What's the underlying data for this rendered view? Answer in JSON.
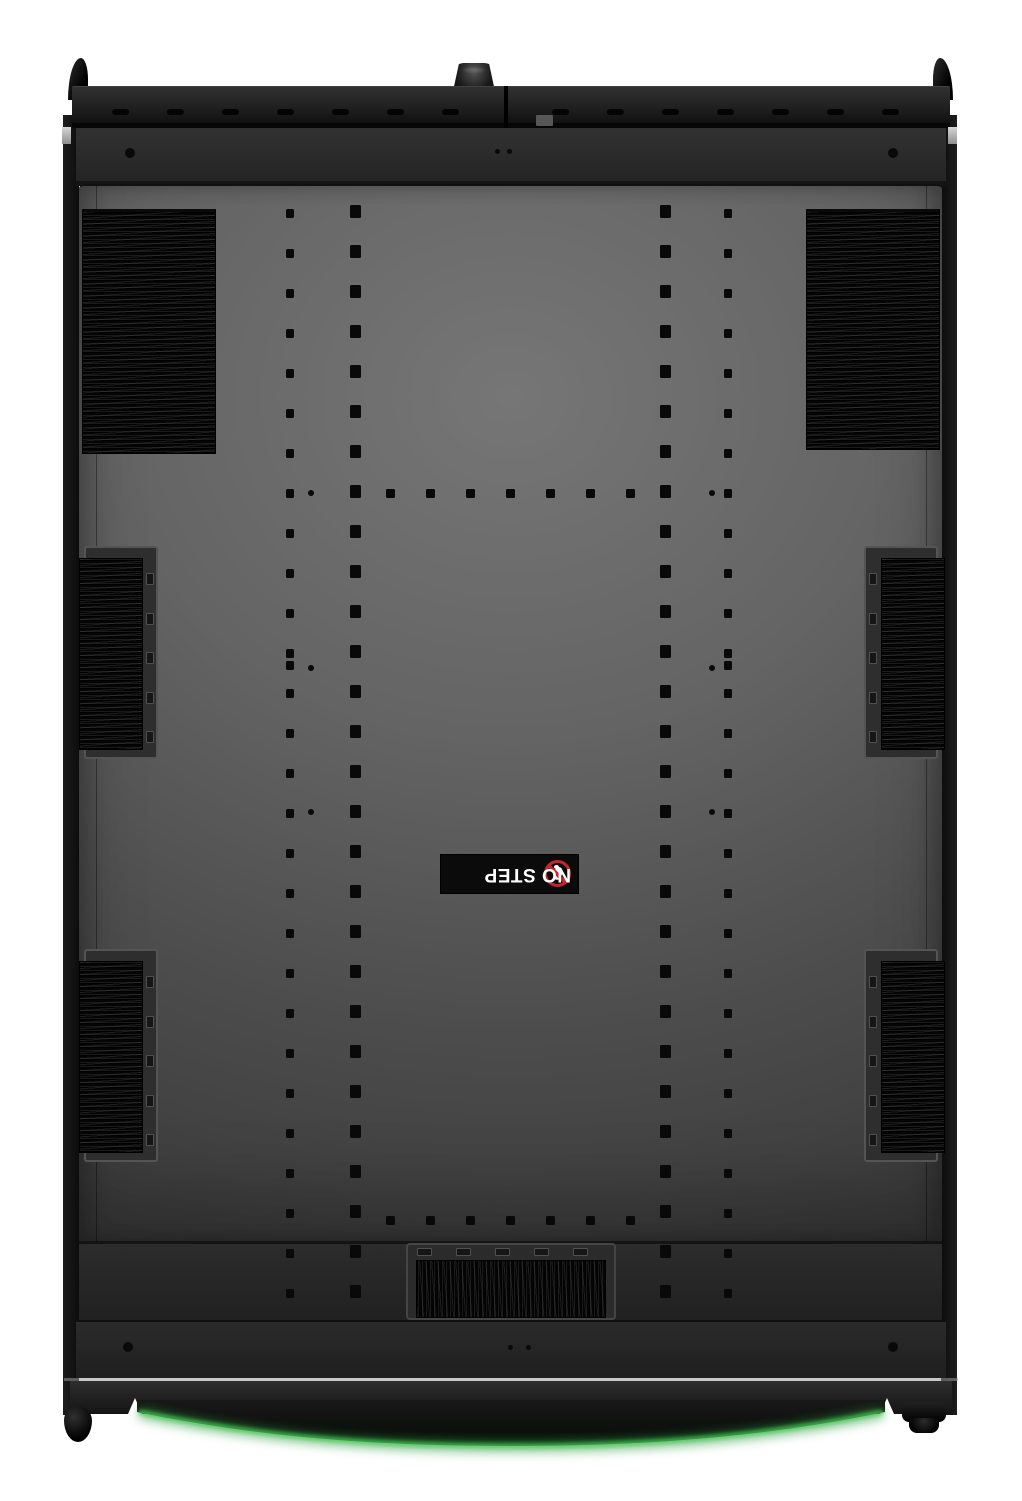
{
  "no_step_label": {
    "text": "NO STEP",
    "icon": "no-step-prohibition-icon"
  },
  "colors": {
    "hole_color": "#090909",
    "label_bg": "#0b0b0b",
    "label_text": "#ffffff",
    "prohibition_red": "#c1272d",
    "glow_green": "#46c455",
    "glow_green_soft": "#2f9e43"
  },
  "perforations": {
    "columns": [
      {
        "x": 290,
        "w": 8,
        "h": 9,
        "y_start": 213,
        "y_end": 1293,
        "step": 40
      },
      {
        "x": 355,
        "w": 11,
        "h": 13,
        "y_start": 211,
        "y_end": 1291,
        "step": 40
      },
      {
        "x": 665,
        "w": 11,
        "h": 13,
        "y_start": 211,
        "y_end": 1291,
        "step": 40
      },
      {
        "x": 728,
        "w": 8,
        "h": 9,
        "y_start": 213,
        "y_end": 1293,
        "step": 40
      }
    ],
    "rows": [
      {
        "y": 493,
        "w": 9,
        "h": 9,
        "x_start": 390,
        "x_end": 630,
        "step": 40
      },
      {
        "y": 1220,
        "w": 9,
        "h": 9,
        "x_start": 390,
        "x_end": 630,
        "step": 40
      }
    ],
    "extra_squares": [
      [
        290,
        665
      ],
      [
        728,
        665
      ]
    ],
    "dots": [
      [
        311,
        493
      ],
      [
        712,
        493
      ],
      [
        311,
        668
      ],
      [
        712,
        668
      ],
      [
        311,
        812
      ],
      [
        712,
        812
      ]
    ]
  },
  "round_holes": {
    "r": 5,
    "positions": [
      [
        130,
        153
      ],
      [
        893,
        153
      ],
      [
        128,
        1347
      ],
      [
        893,
        1347
      ]
    ]
  },
  "tiny_dots": {
    "r": 2.5,
    "positions": [
      [
        497,
        151
      ],
      [
        509,
        151
      ],
      [
        510,
        1347
      ],
      [
        528,
        1347
      ]
    ]
  },
  "slots": {
    "top_rail": {
      "y": 109,
      "w": 17,
      "h": 6,
      "xs": [
        120,
        175,
        230,
        285,
        340,
        395,
        450,
        560,
        615,
        670,
        725,
        780,
        835,
        890
      ]
    },
    "bottom_rail": {
      "y": 1388,
      "w": 18,
      "h": 7,
      "xs": [
        175,
        259,
        343,
        427,
        511,
        595,
        679,
        763,
        847
      ]
    },
    "bottom_grommet": {
      "y": 1248,
      "w": 15,
      "h": 8,
      "xs": [
        424,
        463,
        502,
        541,
        580
      ]
    },
    "side_grommets": {
      "w": 8,
      "h": 12,
      "x_left": 146,
      "x_right": 869,
      "ys": [
        573,
        613,
        652,
        692,
        731,
        976,
        1016,
        1055,
        1095,
        1134
      ]
    }
  }
}
